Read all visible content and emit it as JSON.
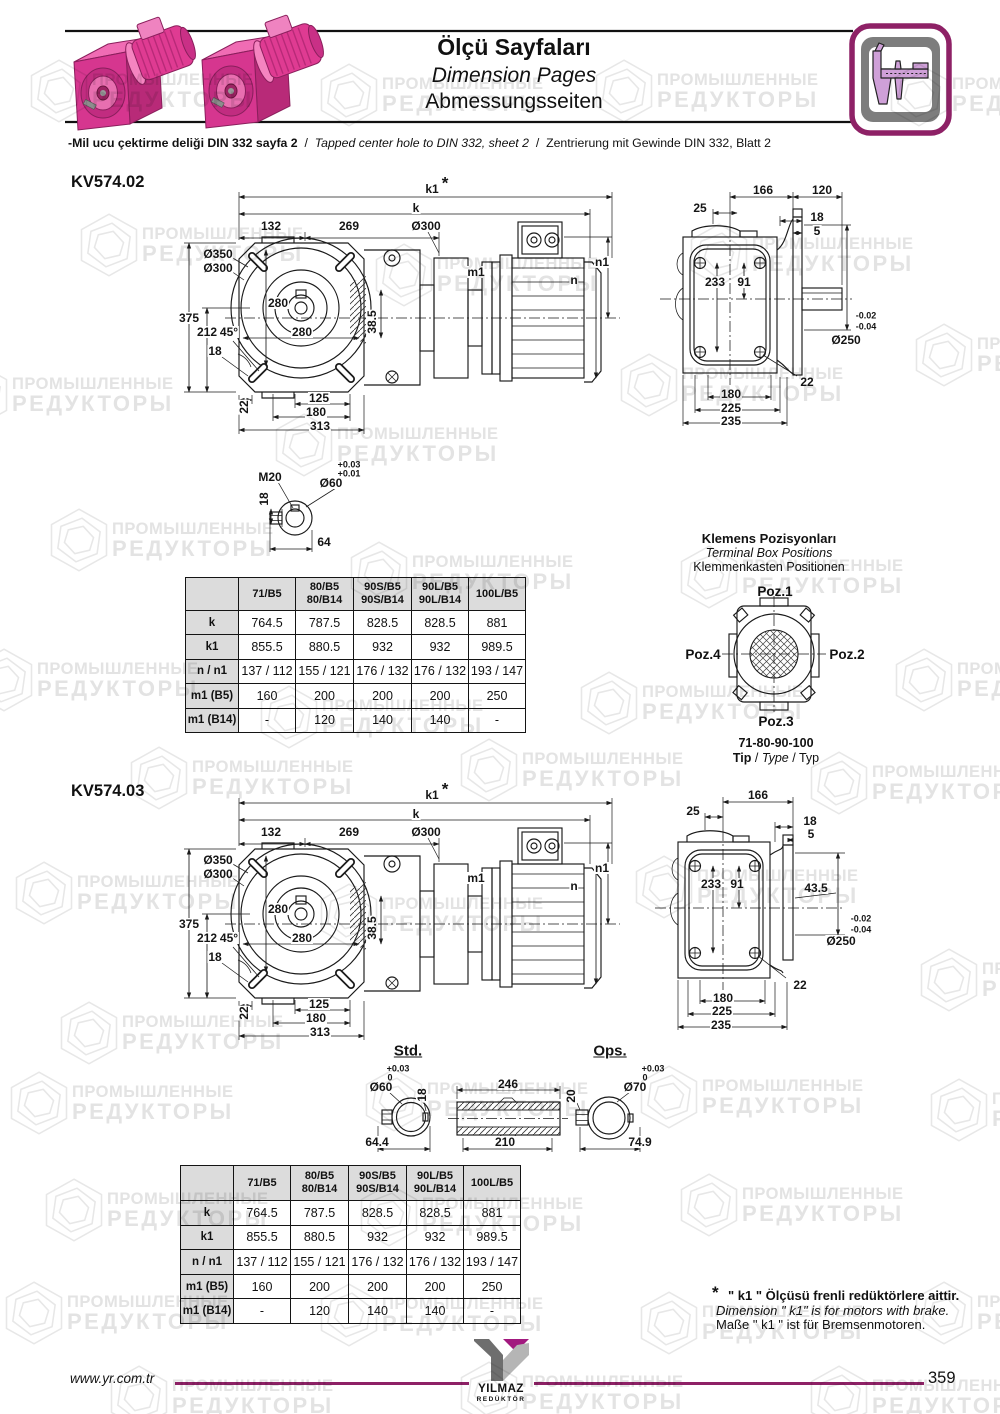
{
  "header": {
    "title_tr": "Ölçü Sayfaları",
    "title_en": "Dimension Pages",
    "title_de": "Abmessungsseiten"
  },
  "note": {
    "tr": "-Mil ucu çektirme deliği DIN 332 sayfa 2",
    "sep": "/",
    "en": "Tapped center hole to DIN 332, sheet 2",
    "de": "Zentrierung mit Gewinde DIN 332, Blatt 2"
  },
  "sections": {
    "kv02": "KV574.02",
    "kv03": "KV574.03"
  },
  "front_view": {
    "k1": "k1",
    "star": "*",
    "k": "k",
    "len132": "132",
    "len269": "269",
    "dia300_top": "Ø300",
    "dia350": "Ø350",
    "dia300": "Ø300",
    "sq280_v": "280",
    "sq280_h": "280",
    "h375": "375",
    "h212": "212",
    "ang45": "45°",
    "off18": "18",
    "h38_5": "38.5",
    "m1": "m1",
    "n1": "n1",
    "n": "n",
    "off22": "22",
    "len125": "125",
    "len180": "180",
    "len313": "313"
  },
  "side_view_02": {
    "w166": "166",
    "w120": "120",
    "t25": "25",
    "t18": "18",
    "t5": "5",
    "v233": "233",
    "v91": "91",
    "tol_a": "-0.02",
    "tol_b": "-0.04",
    "dia250": "Ø250",
    "bolt22": "22",
    "b180": "180",
    "b225": "225",
    "b235": "235"
  },
  "side_view_03": {
    "w166": "166",
    "t25": "25",
    "t18": "18",
    "t5": "5",
    "v233": "233",
    "v91": "91",
    "v43_5": "43.5",
    "tol_a": "-0.02",
    "tol_b": "-0.04",
    "dia250": "Ø250",
    "bolt22": "22",
    "b180": "180",
    "b225": "225",
    "b235": "235"
  },
  "shaft_detail": {
    "m20": "M20",
    "tol_a": "+0.03",
    "tol_b": "+0.01",
    "dia60": "Ø60",
    "key18": "18",
    "len64": "64"
  },
  "std_ops": {
    "std": "Std.",
    "ops": "Ops.",
    "dia60": "Ø60",
    "tol_a": "+0.03",
    "tol_b": "0",
    "key18": "18",
    "len64_4": "64.4",
    "len246": "246",
    "key20": "20",
    "len210": "210",
    "dia70": "Ø70",
    "tol_c": "+0.03",
    "tol_d": "0",
    "len74_9": "74.9"
  },
  "terminal_box": {
    "title_tr": "Klemens Pozisyonları",
    "title_en": "Terminal Box Positions",
    "title_de": "Klemmenkasten Positionen",
    "poz1": "Poz.1",
    "poz2": "Poz.2",
    "poz3": "Poz.3",
    "poz4": "Poz.4",
    "range": "71-80-90-100",
    "tip_tr": "Tip",
    "tip_en": "Type",
    "tip_de": "Typ",
    "sep": "/"
  },
  "dim_table": {
    "col_headers": [
      [
        "71/B5"
      ],
      [
        "80/B5",
        "80/B14"
      ],
      [
        "90S/B5",
        "90S/B14"
      ],
      [
        "90L/B5",
        "90L/B14"
      ],
      [
        "100L/B5"
      ]
    ],
    "rows": [
      {
        "label": "k",
        "values": [
          "764.5",
          "787.5",
          "828.5",
          "828.5",
          "881"
        ]
      },
      {
        "label": "k1",
        "values": [
          "855.5",
          "880.5",
          "932",
          "932",
          "989.5"
        ]
      },
      {
        "label": "n / n1",
        "values": [
          "137 / 112",
          "155 / 121",
          "176 / 132",
          "176 / 132",
          "193 / 147"
        ]
      },
      {
        "label": "m1 (B5)",
        "values": [
          "160",
          "200",
          "200",
          "200",
          "250"
        ]
      },
      {
        "label": "m1 (B14)",
        "values": [
          "-",
          "120",
          "140",
          "140",
          "-"
        ]
      }
    ]
  },
  "footnote": {
    "star": "*",
    "tr": "\" k1 \" Ölçüsü frenli redüktörlere aittir.",
    "en": "Dimension \" k1\" is for motors with brake.",
    "de": "Maße \" k1 \" ist für Bremsenmotoren."
  },
  "footer": {
    "url": "www.yr.com.tr",
    "logo_top": "YILMAZ",
    "logo_sub": "REDÜKTÖR",
    "page": "359"
  },
  "watermark": {
    "line1": "ПРОМЫШЛЕННЫЕ",
    "line2": "РЕДУКТОРЫ"
  },
  "colors": {
    "brand_purple": "#8e2166",
    "motor_pink": "#e0399a",
    "caliper_violet": "#cfa0d8",
    "table_header_bg": "#dcdcdc",
    "watermark_gray": "#e3e3e3"
  }
}
